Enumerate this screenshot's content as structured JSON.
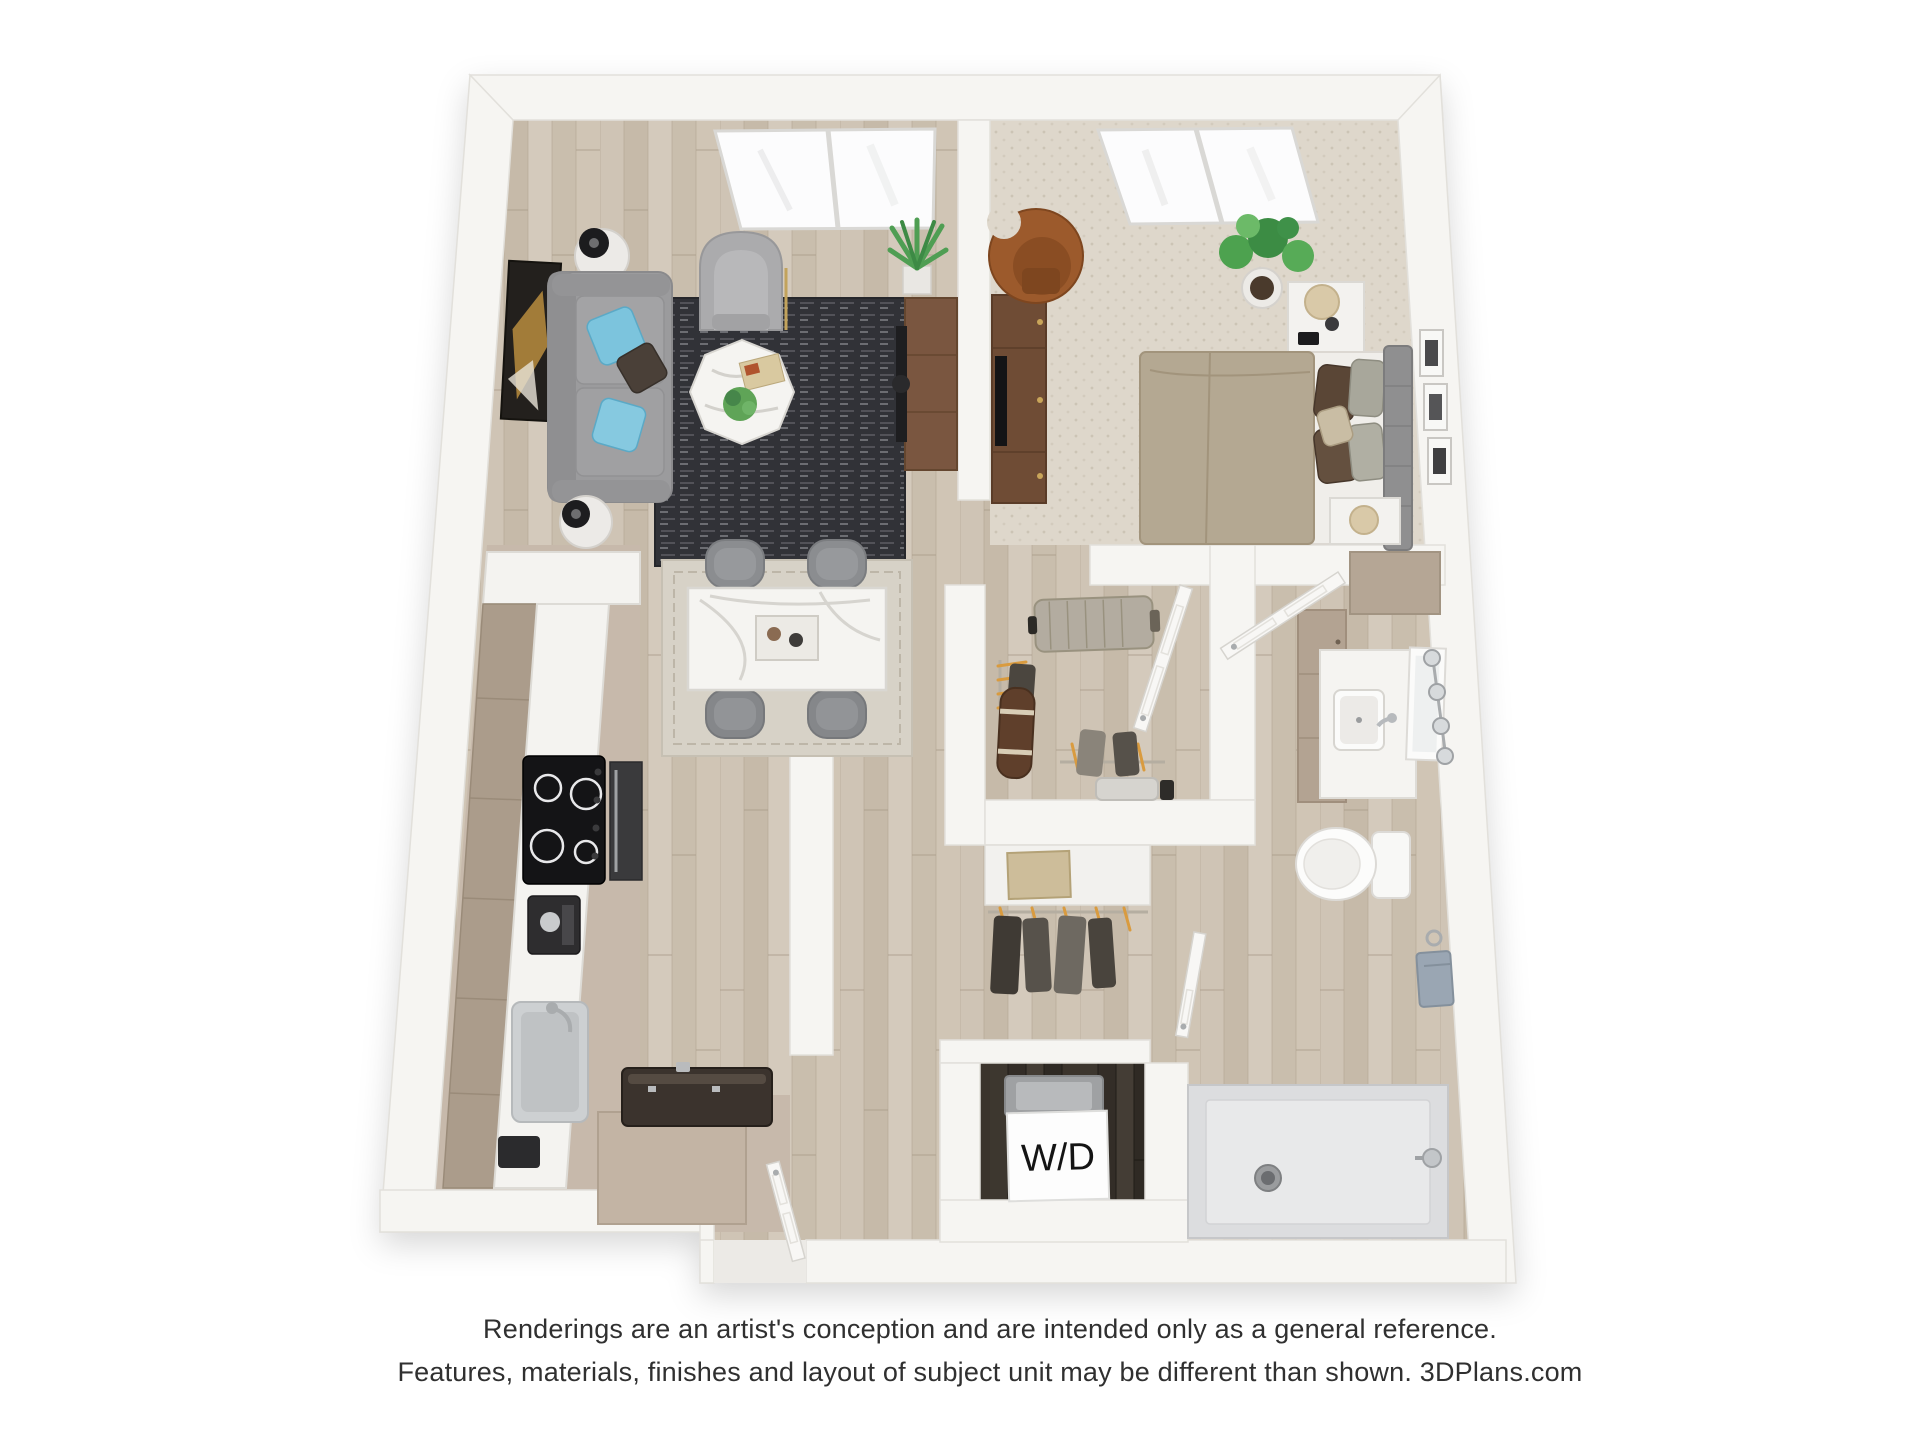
{
  "labels": {
    "washer_dryer": "W/D"
  },
  "caption": {
    "line1": "Renderings are an artist's conception and are intended only as a general reference.",
    "line2": "Features, materials, finishes and layout of subject unit may be different than shown. 3DPlans.com"
  },
  "palette": {
    "background": "#ffffff",
    "wall": "#f6f5f2",
    "wall_edge": "#e2e0db",
    "wood_floor": "#cdc2b3",
    "kitchen_floor": "#c7b9ab",
    "carpet": "#ded7cb",
    "dark_closet_floor": "#39332d",
    "rug_dark": "#313237",
    "dining_rug": "#d7d2c7",
    "sofa_gray": "#9b9b9d",
    "pillow_blue": "#7cc4dd",
    "cabinet_taupe": "#b3a392",
    "counter_white": "#f4f3f0",
    "console_brown": "#7a5640",
    "desk_brown": "#6f4c35",
    "leather_chair": "#9c5a2c",
    "bed_duvet": "#b4a892",
    "plant_green": "#4f9e53",
    "marble_white": "#f5f4f1",
    "shower_pan": "#e8e9ea",
    "towel_blue": "#9aa6b3",
    "label_text": "#141414",
    "caption_text": "#303030"
  }
}
